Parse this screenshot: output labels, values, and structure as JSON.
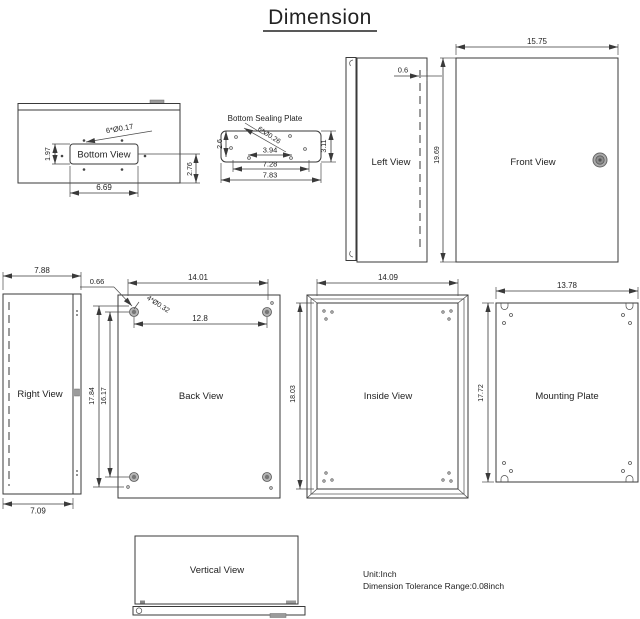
{
  "title": "Dimension",
  "footer": {
    "unit": "Unit:Inch",
    "tolerance": "Dimension Tolerance Range:0.08inch"
  },
  "views": {
    "bottom": {
      "label": "Bottom View",
      "holes": "6*Ø0.17",
      "d_height": "1.97",
      "d_width": "6.69",
      "d_offset": "2.76"
    },
    "sealing": {
      "label": "Bottom Sealing Plate",
      "d_edge": "2.6",
      "holes": "6*Ø0.26",
      "d_inner": "3.94",
      "d_mid": "7.28",
      "d_outer": "7.83",
      "d_height": "3.11"
    },
    "left": {
      "label": "Left View",
      "d_door": "0.6",
      "d_height": "19.69"
    },
    "front": {
      "label": "Front View",
      "d_width": "15.75"
    },
    "right": {
      "label": "Right View",
      "d_top": "7.88",
      "d_bottom": "7.09"
    },
    "back": {
      "label": "Back View",
      "d_offset": "0.66",
      "d_span_w": "14.01",
      "holes": "4*Ø0.32",
      "d_inner_w": "12.8",
      "d_span_h": "17.84",
      "d_inner_h": "16.17"
    },
    "inside": {
      "label": "Inside View",
      "d_width": "14.09",
      "d_height": "18.03"
    },
    "mounting": {
      "label": "Mounting Plate",
      "d_width": "13.78",
      "d_height": "17.72"
    },
    "vertical": {
      "label": "Vertical View"
    }
  },
  "colors": {
    "line": "#3a3a3a",
    "hole_gray": "#9b9b9b",
    "background": "#ffffff"
  }
}
